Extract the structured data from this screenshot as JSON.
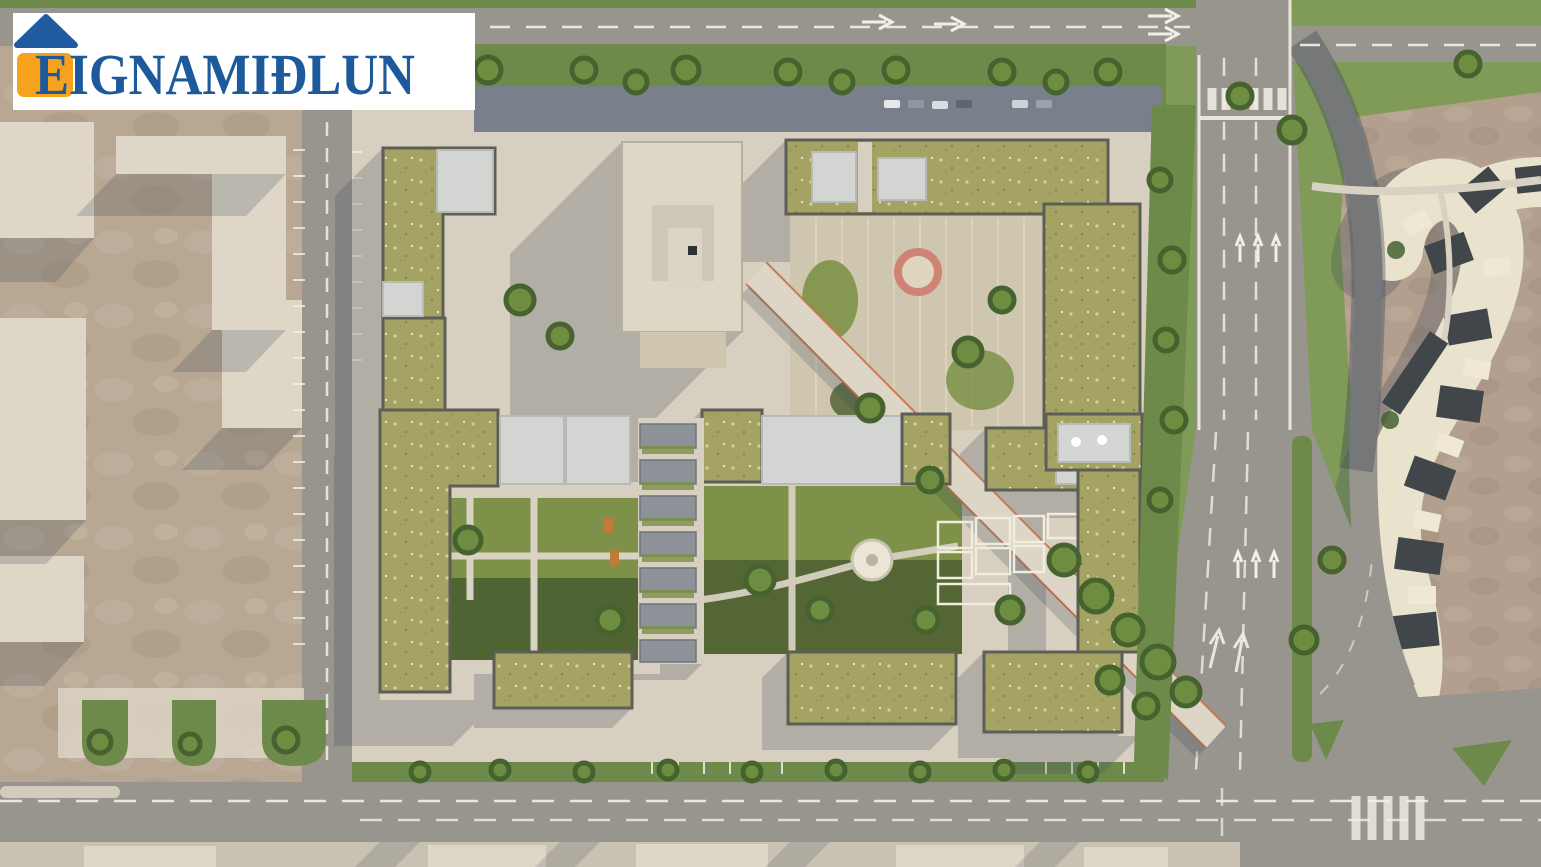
{
  "page": {
    "kind": "real-estate aerial 3D render",
    "description": "Top-down architectural rendering of a residential development block with green roofs, courtyards, a diagonal promenade, surrounding roads and an existing curved building complex"
  },
  "logo": {
    "text": "EIGNAMIÐLUN",
    "icon": "house-icon",
    "roof_color": "#1f5b9e",
    "body_color": "#f6a21c",
    "text_color": "#1d5a9c",
    "background": "#ffffff"
  },
  "scene": {
    "regions": [
      "industrial-yard-west",
      "left-street",
      "development-site",
      "green-roof-apartment-blocks",
      "community-tower",
      "northeast-terraced-courtyard",
      "pink-circle-feature",
      "central-garden-with-gazebo",
      "townhouse-row",
      "diagonal-promenade",
      "main-arterial-road-east",
      "curved-road",
      "existing-complex-east",
      "top-road",
      "bottom-road",
      "tree-lined-verges"
    ]
  },
  "palette": {
    "asphalt": "#98958e",
    "asphaltShadow": "#75787d",
    "paving": "#d7cfbf",
    "pavingBright": "#e0d9c9",
    "tan": "#b7a793",
    "tanLight": "#ded7c8",
    "greenRoof": "#a5a363",
    "parapet": "#5c5f55",
    "lawn": "#7d9148",
    "lawnDark": "#4b5e31",
    "grass": "#7f9b57",
    "grassDark": "#6d8a4a",
    "tree": "#45622f",
    "treeLight": "#6e8d41",
    "beige": "#ded7c5",
    "plaza": "#b29f8e",
    "cream": "#e9e2cd",
    "darkRoof": "#41464b",
    "accentPath": "#c9714b",
    "pinkRing": "#d08275",
    "roadLine": "#f2efe6",
    "shadow": "#3d4758",
    "carportShadow": "#79808b"
  }
}
